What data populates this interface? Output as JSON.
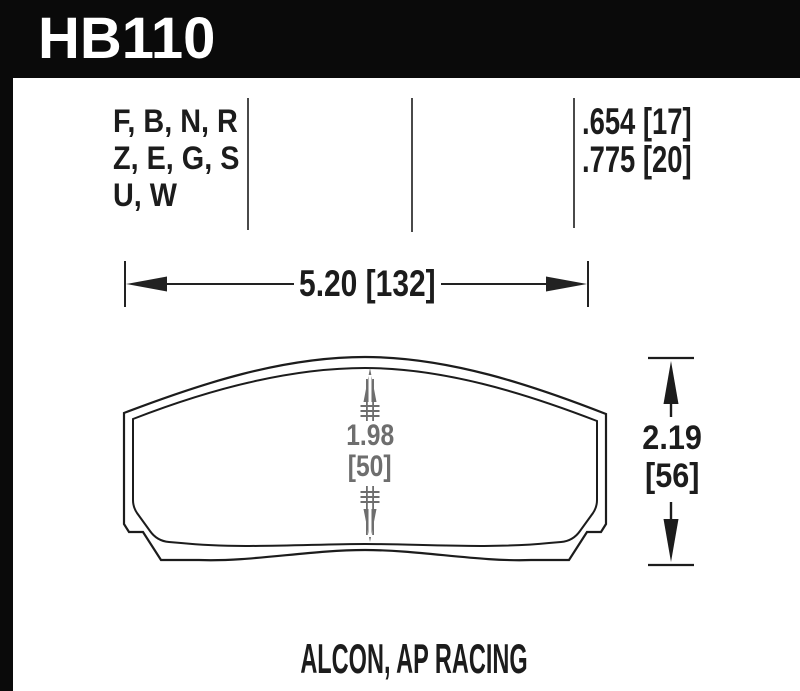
{
  "header": {
    "part_number": "HB110"
  },
  "compound_codes": {
    "lines": [
      "F, B, N, R",
      "Z, E, G, S",
      "U, W"
    ]
  },
  "thickness_specs": {
    "lines": [
      ".654 [17]",
      ".775 [20]"
    ]
  },
  "dimensions": {
    "width": {
      "label": "5.20 [132]"
    },
    "pad_height_center": {
      "value": "1.98",
      "metric": "[50]"
    },
    "overall_height": {
      "value": "2.19",
      "metric": "[56]"
    }
  },
  "caption": {
    "applications": "ALCON, AP RACING"
  },
  "colors": {
    "header_bg": "#0a0a0a",
    "header_text": "#ffffff",
    "line_black": "#1c1c1c",
    "dimension_gray": "#6e6e6e",
    "divider_gray": "#4a4a4a",
    "background": "#ffffff"
  }
}
